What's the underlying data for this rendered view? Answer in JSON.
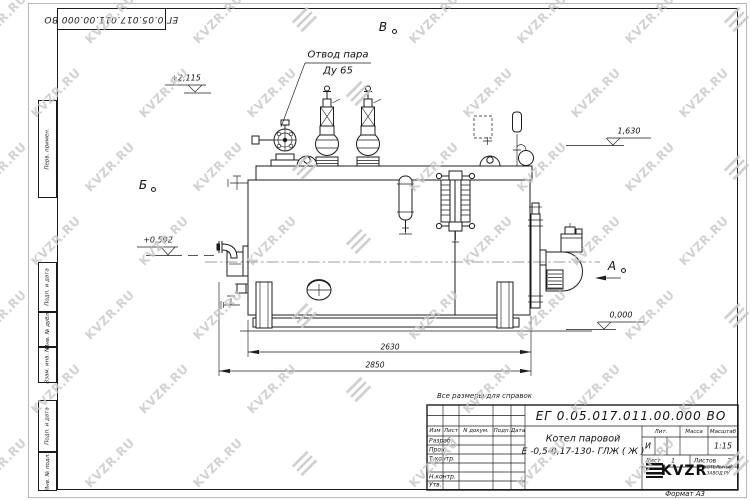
{
  "watermark": {
    "text": "KVZR.RU"
  },
  "top_stamp": {
    "doc_number": "ЕГ 0.05.017.011.00.000  ВО"
  },
  "side_column": {
    "labels": [
      "Перв. примен.",
      "Подп. и дата",
      "Инв. № дубл.",
      "Взам. инв. №",
      "Подп. и дата",
      "Инв. № подл."
    ]
  },
  "drawing": {
    "callout": {
      "line1": "Отвод пара",
      "line2": "Ду 65"
    },
    "views": {
      "top": "В",
      "left": "Б",
      "right": "А"
    },
    "levels": {
      "top": "+2,115",
      "upper_right": "1,630",
      "mid_left": "+0,592",
      "base_right": "0,000"
    },
    "dimensions": {
      "body_length": "2630",
      "overall_length": "2850"
    }
  },
  "note": "Все размеры для справок",
  "title_block": {
    "doc_number": "ЕГ 0.05.017.011.00.000  ВО",
    "product": {
      "line1": "Котел паровой",
      "line2": "Е -0,5-0,17-130- ГЛЖ ( Ж )"
    },
    "headers": {
      "izm": "Изм",
      "list": "Лист",
      "doc": "N докум.",
      "sign": "Подп.",
      "date": "Дата",
      "lit": "Лит.",
      "mass": "Масса",
      "scale": "Масштаб"
    },
    "roles": {
      "razrab": "Разраб.",
      "prov": "Пров.",
      "tkontr": "Т.контр.",
      "nkontr": "Н.контр.",
      "utv": "Утв."
    },
    "lit_value": "И",
    "scale_value": "1:15",
    "sheet": {
      "label": "Лист",
      "value": "1",
      "total_label": "Листов",
      "total_value": "2"
    },
    "logo": {
      "name": "KVZR",
      "sub1": "КОТЕЛЬНЫЙ",
      "sub2": "ЗАВОД.РУ"
    },
    "format": "Формат А3"
  }
}
